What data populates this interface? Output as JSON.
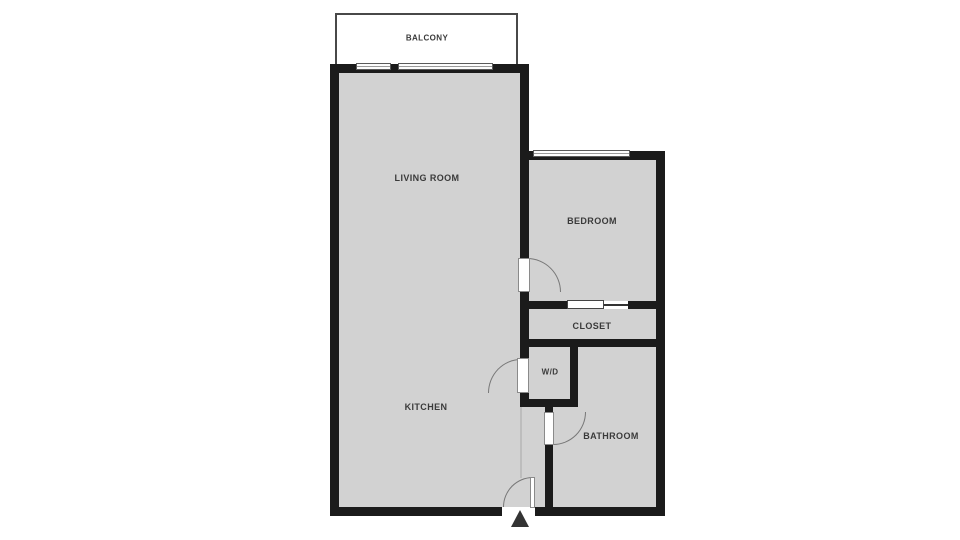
{
  "plan": {
    "type": "apartment-floor-plan",
    "rooms": {
      "balcony": {
        "label": "BALCONY"
      },
      "living_room": {
        "label": "LIVING ROOM"
      },
      "bedroom": {
        "label": "BEDROOM"
      },
      "closet": {
        "label": "CLOSET"
      },
      "wd": {
        "label": "W/D"
      },
      "kitchen": {
        "label": "KITCHEN"
      },
      "bathroom": {
        "label": "BATHROOM"
      }
    },
    "features": {
      "entrance_marker_icon": "up-arrow-icon",
      "door_symbols": "quarter-circle-swing",
      "window_symbols": "double-line-band",
      "closet_door_symbol": "pocket-sliding-door"
    }
  },
  "colors": {
    "wall": "#1b1b1b",
    "floor": "#d2d2d2",
    "bg": "#ffffff",
    "label": "#3a3a3a",
    "arc": "#777777",
    "window-border": "#5a5a5a",
    "divider": "#bdbdbd",
    "marker": "#333333",
    "balcony-outline": "#484848"
  }
}
